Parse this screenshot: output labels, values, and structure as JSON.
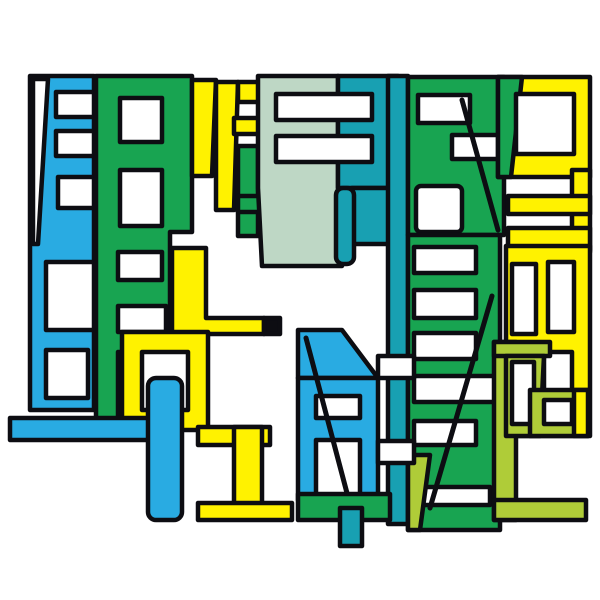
{
  "artwork": {
    "description": "abstract-letterform-collage",
    "background": "#FFFFFF",
    "canvas": {
      "width": 600,
      "height": 600
    },
    "outline": {
      "color": "#0D0D12",
      "width": 4.5
    },
    "palette": {
      "blue": "#29ABE2",
      "teal": "#18A0B2",
      "green": "#18A451",
      "yellow": "#FFF200",
      "sage": "#BED7C5",
      "lime": "#AFCC38",
      "white": "#FFFFFF",
      "ink": "#0D0D12"
    },
    "shapes": [
      {
        "name": "blue-tower-slab",
        "type": "rect",
        "x": 30,
        "y": 76,
        "w": 64,
        "h": 334,
        "fill": "blue"
      },
      {
        "name": "blue-tower-white-wedge",
        "type": "polygon",
        "points": [
          [
            33,
            79
          ],
          [
            48,
            79
          ],
          [
            38,
            244
          ],
          [
            33,
            244
          ]
        ],
        "fill": "white"
      },
      {
        "name": "blue-tower-window-1",
        "type": "rect",
        "x": 56,
        "y": 92,
        "w": 38,
        "h": 25,
        "fill": "white"
      },
      {
        "name": "blue-tower-window-2",
        "type": "rect",
        "x": 56,
        "y": 131,
        "w": 38,
        "h": 25,
        "fill": "white"
      },
      {
        "name": "blue-tower-window-3",
        "type": "rect",
        "x": 58,
        "y": 177,
        "w": 36,
        "h": 31,
        "fill": "white"
      },
      {
        "name": "blue-tower-window-4",
        "type": "rect",
        "x": 46,
        "y": 262,
        "w": 48,
        "h": 68,
        "fill": "white"
      },
      {
        "name": "blue-tower-window-5",
        "type": "rect",
        "x": 46,
        "y": 350,
        "w": 42,
        "h": 48,
        "fill": "white"
      },
      {
        "name": "green-tower-slab",
        "type": "polygon",
        "points": [
          [
            96,
            76
          ],
          [
            192,
            76
          ],
          [
            192,
            232
          ],
          [
            170,
            232
          ],
          [
            170,
            432
          ],
          [
            96,
            432
          ]
        ],
        "fill": "green"
      },
      {
        "name": "green-tower-window-1",
        "type": "rect",
        "x": 120,
        "y": 98,
        "w": 42,
        "h": 44,
        "fill": "white"
      },
      {
        "name": "green-tower-window-2",
        "type": "rect",
        "x": 120,
        "y": 170,
        "w": 42,
        "h": 56,
        "fill": "white"
      },
      {
        "name": "green-tower-window-3",
        "type": "rect",
        "x": 118,
        "y": 252,
        "w": 44,
        "h": 28,
        "fill": "white"
      },
      {
        "name": "green-tower-window-4",
        "type": "rect",
        "x": 118,
        "y": 306,
        "w": 48,
        "h": 26,
        "fill": "white"
      },
      {
        "name": "green-tower-window-5",
        "type": "rect",
        "x": 118,
        "y": 352,
        "w": 56,
        "h": 64,
        "fill": "white"
      },
      {
        "name": "yellow-j-stem",
        "type": "polygon",
        "points": [
          [
            192,
            80
          ],
          [
            216,
            80
          ],
          [
            212,
            176
          ],
          [
            192,
            176
          ]
        ],
        "fill": "yellow"
      },
      {
        "name": "yellow-f-stem",
        "type": "polygon",
        "points": [
          [
            216,
            82
          ],
          [
            238,
            82
          ],
          [
            234,
            210
          ],
          [
            216,
            210
          ]
        ],
        "fill": "yellow"
      },
      {
        "name": "yellow-f-arm-top",
        "type": "rect",
        "x": 238,
        "y": 82,
        "w": 26,
        "h": 20,
        "fill": "yellow"
      },
      {
        "name": "yellow-f-arm-mid",
        "type": "rect",
        "x": 234,
        "y": 118,
        "w": 28,
        "h": 16,
        "fill": "yellow"
      },
      {
        "name": "green-h-left-bar",
        "type": "rect",
        "x": 238,
        "y": 146,
        "w": 20,
        "h": 90,
        "fill": "green"
      },
      {
        "name": "green-h-right-bar",
        "type": "rect",
        "x": 284,
        "y": 146,
        "w": 20,
        "h": 90,
        "fill": "green"
      },
      {
        "name": "green-h-crossbar",
        "type": "rect",
        "x": 238,
        "y": 196,
        "w": 66,
        "h": 16,
        "fill": "green"
      },
      {
        "name": "sage-e-slab",
        "type": "polygon",
        "points": [
          [
            258,
            76
          ],
          [
            338,
            76
          ],
          [
            338,
            188
          ],
          [
            342,
            266
          ],
          [
            262,
            266
          ],
          [
            258,
            188
          ]
        ],
        "fill": "sage"
      },
      {
        "name": "teal-e-slab",
        "type": "rect",
        "x": 338,
        "y": 76,
        "w": 60,
        "h": 112,
        "fill": "teal"
      },
      {
        "name": "e-window-1",
        "type": "rect",
        "x": 276,
        "y": 94,
        "w": 96,
        "h": 26,
        "fill": "white"
      },
      {
        "name": "e-window-2",
        "type": "rect",
        "x": 276,
        "y": 136,
        "w": 96,
        "h": 26,
        "fill": "white"
      },
      {
        "name": "teal-bowl",
        "type": "rect",
        "x": 352,
        "y": 188,
        "w": 46,
        "h": 56,
        "fill": "teal"
      },
      {
        "name": "teal-descender",
        "type": "rect",
        "x": 336,
        "y": 188,
        "w": 18,
        "h": 76,
        "rx": 7,
        "fill": "teal"
      },
      {
        "name": "teal-spine",
        "type": "rect",
        "x": 388,
        "y": 76,
        "w": 20,
        "h": 448,
        "fill": "teal"
      },
      {
        "name": "green-r-slab",
        "type": "rect",
        "x": 408,
        "y": 77,
        "w": 96,
        "h": 158,
        "fill": "green"
      },
      {
        "name": "green-r-window-1",
        "type": "rect",
        "x": 418,
        "y": 95,
        "w": 52,
        "h": 28,
        "fill": "white"
      },
      {
        "name": "green-r-window-2",
        "type": "rect",
        "x": 452,
        "y": 135,
        "w": 48,
        "h": 24,
        "fill": "white"
      },
      {
        "name": "green-r-window-3",
        "type": "rect",
        "x": 416,
        "y": 186,
        "w": 46,
        "h": 46,
        "rx": 5,
        "fill": "white"
      },
      {
        "name": "green-r-diagonal",
        "type": "line",
        "x1": 462,
        "y1": 100,
        "x2": 498,
        "y2": 230
      },
      {
        "name": "green-ladder-slab",
        "type": "rect",
        "x": 408,
        "y": 235,
        "w": 92,
        "h": 295,
        "fill": "green"
      },
      {
        "name": "green-ladder-window-1",
        "type": "rect",
        "x": 414,
        "y": 247,
        "w": 62,
        "h": 26,
        "fill": "white"
      },
      {
        "name": "green-ladder-window-2",
        "type": "rect",
        "x": 414,
        "y": 290,
        "w": 62,
        "h": 28,
        "fill": "white"
      },
      {
        "name": "green-ladder-window-3",
        "type": "rect",
        "x": 414,
        "y": 333,
        "w": 62,
        "h": 26,
        "fill": "white"
      },
      {
        "name": "green-ladder-window-4",
        "type": "rect",
        "x": 414,
        "y": 376,
        "w": 84,
        "h": 26,
        "fill": "white"
      },
      {
        "name": "green-ladder-window-5",
        "type": "rect",
        "x": 414,
        "y": 421,
        "w": 62,
        "h": 24,
        "fill": "white"
      },
      {
        "name": "green-ladder-window-6",
        "type": "rect",
        "x": 414,
        "y": 487,
        "w": 76,
        "h": 18,
        "fill": "white"
      },
      {
        "name": "green-ladder-lime-wedge",
        "type": "polygon",
        "points": [
          [
            408,
            455
          ],
          [
            430,
            455
          ],
          [
            420,
            530
          ],
          [
            408,
            530
          ]
        ],
        "fill": "lime"
      },
      {
        "name": "green-ladder-diagonal",
        "type": "line",
        "x1": 492,
        "y1": 296,
        "x2": 430,
        "y2": 508
      },
      {
        "name": "yellow-o-slab",
        "type": "rect",
        "x": 498,
        "y": 77,
        "w": 92,
        "h": 100,
        "fill": "yellow"
      },
      {
        "name": "yellow-o-green-edge",
        "type": "polygon",
        "points": [
          [
            498,
            77
          ],
          [
            522,
            77
          ],
          [
            511,
            177
          ],
          [
            498,
            177
          ]
        ],
        "fill": "green"
      },
      {
        "name": "yellow-o-window",
        "type": "rect",
        "x": 516,
        "y": 94,
        "w": 58,
        "h": 60,
        "fill": "white"
      },
      {
        "name": "yellow-right-conn",
        "type": "rect",
        "x": 572,
        "y": 170,
        "w": 18,
        "h": 80,
        "fill": "yellow"
      },
      {
        "name": "yellow-e-bar-1",
        "type": "rect",
        "x": 508,
        "y": 196,
        "w": 82,
        "h": 18,
        "fill": "yellow"
      },
      {
        "name": "yellow-e-bar-2",
        "type": "rect",
        "x": 508,
        "y": 228,
        "w": 82,
        "h": 24,
        "fill": "yellow"
      },
      {
        "name": "yellow-ring-slab",
        "type": "rect",
        "x": 506,
        "y": 246,
        "w": 84,
        "h": 190,
        "fill": "yellow"
      },
      {
        "name": "yellow-ring-window-1",
        "type": "rect",
        "x": 512,
        "y": 264,
        "w": 24,
        "h": 70,
        "fill": "white"
      },
      {
        "name": "yellow-ring-window-2",
        "type": "rect",
        "x": 548,
        "y": 262,
        "w": 26,
        "h": 70,
        "fill": "white"
      },
      {
        "name": "yellow-ring-window-3",
        "type": "rect",
        "x": 544,
        "y": 352,
        "w": 28,
        "h": 60,
        "fill": "white"
      },
      {
        "name": "lime-leg",
        "type": "rect",
        "x": 494,
        "y": 342,
        "w": 22,
        "h": 178,
        "fill": "lime"
      },
      {
        "name": "lime-crossbar",
        "type": "rect",
        "x": 494,
        "y": 342,
        "w": 56,
        "h": 14,
        "fill": "lime"
      },
      {
        "name": "lime-patch",
        "type": "polygon",
        "points": [
          [
            506,
            356
          ],
          [
            544,
            356
          ],
          [
            540,
            436
          ],
          [
            506,
            436
          ]
        ],
        "fill": "lime"
      },
      {
        "name": "lime-patch-window",
        "type": "rect",
        "x": 512,
        "y": 362,
        "w": 22,
        "h": 62,
        "fill": "white"
      },
      {
        "name": "lime-ring",
        "type": "rect",
        "x": 530,
        "y": 390,
        "w": 58,
        "h": 46,
        "fill": "lime"
      },
      {
        "name": "lime-ring-yellow-edge",
        "type": "rect",
        "x": 574,
        "y": 390,
        "w": 14,
        "h": 46,
        "fill": "yellow"
      },
      {
        "name": "lime-ring-window",
        "type": "rect",
        "x": 544,
        "y": 400,
        "w": 28,
        "h": 24,
        "fill": "white"
      },
      {
        "name": "lime-foot",
        "type": "rect",
        "x": 494,
        "y": 500,
        "w": 92,
        "h": 20,
        "fill": "lime"
      },
      {
        "name": "yellow-l",
        "type": "polygon",
        "points": [
          [
            172,
            248
          ],
          [
            206,
            248
          ],
          [
            206,
            318
          ],
          [
            264,
            318
          ],
          [
            264,
            334
          ],
          [
            172,
            334
          ]
        ],
        "fill": "yellow"
      },
      {
        "name": "black-square",
        "type": "rect",
        "x": 264,
        "y": 318,
        "w": 16,
        "h": 16,
        "fill": "ink"
      },
      {
        "name": "yellow-o2-slab",
        "type": "rect",
        "x": 122,
        "y": 332,
        "w": 86,
        "h": 98,
        "fill": "yellow"
      },
      {
        "name": "yellow-o2-window",
        "type": "rect",
        "x": 142,
        "y": 352,
        "w": 46,
        "h": 58,
        "fill": "white"
      },
      {
        "name": "blue-arm",
        "type": "rect",
        "x": 10,
        "y": 418,
        "w": 140,
        "h": 22,
        "fill": "blue"
      },
      {
        "name": "blue-descender",
        "type": "rect",
        "x": 148,
        "y": 378,
        "w": 34,
        "h": 142,
        "rx": 8,
        "fill": "blue"
      },
      {
        "name": "yellow-i-top",
        "type": "rect",
        "x": 198,
        "y": 427,
        "w": 72,
        "h": 18,
        "fill": "yellow"
      },
      {
        "name": "yellow-i-stem",
        "type": "rect",
        "x": 234,
        "y": 427,
        "w": 28,
        "h": 80,
        "fill": "yellow"
      },
      {
        "name": "yellow-i-base",
        "type": "rect",
        "x": 198,
        "y": 503,
        "w": 94,
        "h": 17,
        "fill": "yellow"
      },
      {
        "name": "blue-m-top",
        "type": "polygon",
        "points": [
          [
            298,
            330
          ],
          [
            342,
            330
          ],
          [
            378,
            378
          ],
          [
            298,
            378
          ]
        ],
        "fill": "blue"
      },
      {
        "name": "blue-m-slab",
        "type": "rect",
        "x": 298,
        "y": 378,
        "w": 80,
        "h": 122,
        "fill": "blue"
      },
      {
        "name": "blue-m-window-1",
        "type": "rect",
        "x": 316,
        "y": 396,
        "w": 44,
        "h": 22,
        "fill": "white"
      },
      {
        "name": "blue-m-window-2",
        "type": "rect",
        "x": 316,
        "y": 440,
        "w": 44,
        "h": 60,
        "fill": "white"
      },
      {
        "name": "blue-m-diagonal",
        "type": "line",
        "x1": 306,
        "y1": 338,
        "x2": 352,
        "y2": 512
      },
      {
        "name": "cross-bar-white-1",
        "type": "rect",
        "x": 378,
        "y": 356,
        "w": 36,
        "h": 22,
        "fill": "white"
      },
      {
        "name": "cross-bar-white-2",
        "type": "rect",
        "x": 378,
        "y": 441,
        "w": 36,
        "h": 22,
        "fill": "white"
      },
      {
        "name": "green-base-bar",
        "type": "rect",
        "x": 298,
        "y": 494,
        "w": 92,
        "h": 26,
        "fill": "green"
      },
      {
        "name": "teal-tab",
        "type": "rect",
        "x": 340,
        "y": 508,
        "w": 22,
        "h": 38,
        "fill": "teal"
      }
    ]
  }
}
